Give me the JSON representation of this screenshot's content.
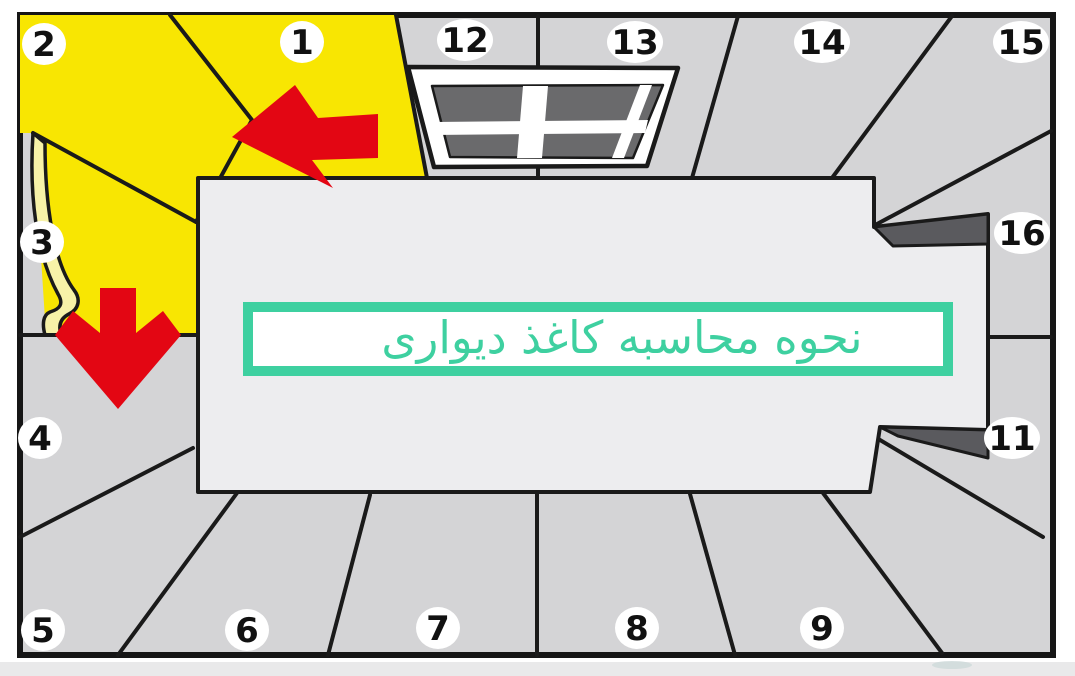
{
  "colors": {
    "page_margin": "#ffffff",
    "bottom_band": "#e9e9ea",
    "wall": "#d4d4d6",
    "border": "#161616",
    "line": "#1a1a1a",
    "box": "#ededef",
    "yellow": "#f8e602",
    "curl": "#f7f2a8",
    "wedge": "#5a5a5e",
    "pane": "#6a6a6c",
    "window_frame": "#ffffff",
    "red": "#e30613",
    "teal": "#3ed0a0",
    "label_bg": "#ffffff",
    "label_text": "#111111",
    "smudge": "#cdd9da"
  },
  "diagram": {
    "title": {
      "text": "نحوه محاسبه کاغذ دیواری"
    },
    "highlighted_strips": [
      "1",
      "2",
      "3"
    ],
    "strips": [
      {
        "label": "1",
        "x": 302,
        "y": 42
      },
      {
        "label": "2",
        "x": 44,
        "y": 44
      },
      {
        "label": "3",
        "x": 42,
        "y": 242
      },
      {
        "label": "4",
        "x": 40,
        "y": 438
      },
      {
        "label": "5",
        "x": 43,
        "y": 630
      },
      {
        "label": "6",
        "x": 247,
        "y": 630
      },
      {
        "label": "7",
        "x": 438,
        "y": 628
      },
      {
        "label": "8",
        "x": 637,
        "y": 628
      },
      {
        "label": "9",
        "x": 822,
        "y": 628
      },
      {
        "label": "11",
        "x": 1012,
        "y": 438
      },
      {
        "label": "12",
        "x": 465,
        "y": 40
      },
      {
        "label": "13",
        "x": 635,
        "y": 42
      },
      {
        "label": "14",
        "x": 822,
        "y": 42
      },
      {
        "label": "15",
        "x": 1021,
        "y": 42
      },
      {
        "label": "16",
        "x": 1022,
        "y": 233
      }
    ],
    "icons": {
      "left_arrow": "arrow-left-icon",
      "down_arrow": "arrow-down-icon",
      "window": "window-4-pane-icon",
      "peel": "wallpaper-peel-corner-icon"
    }
  }
}
